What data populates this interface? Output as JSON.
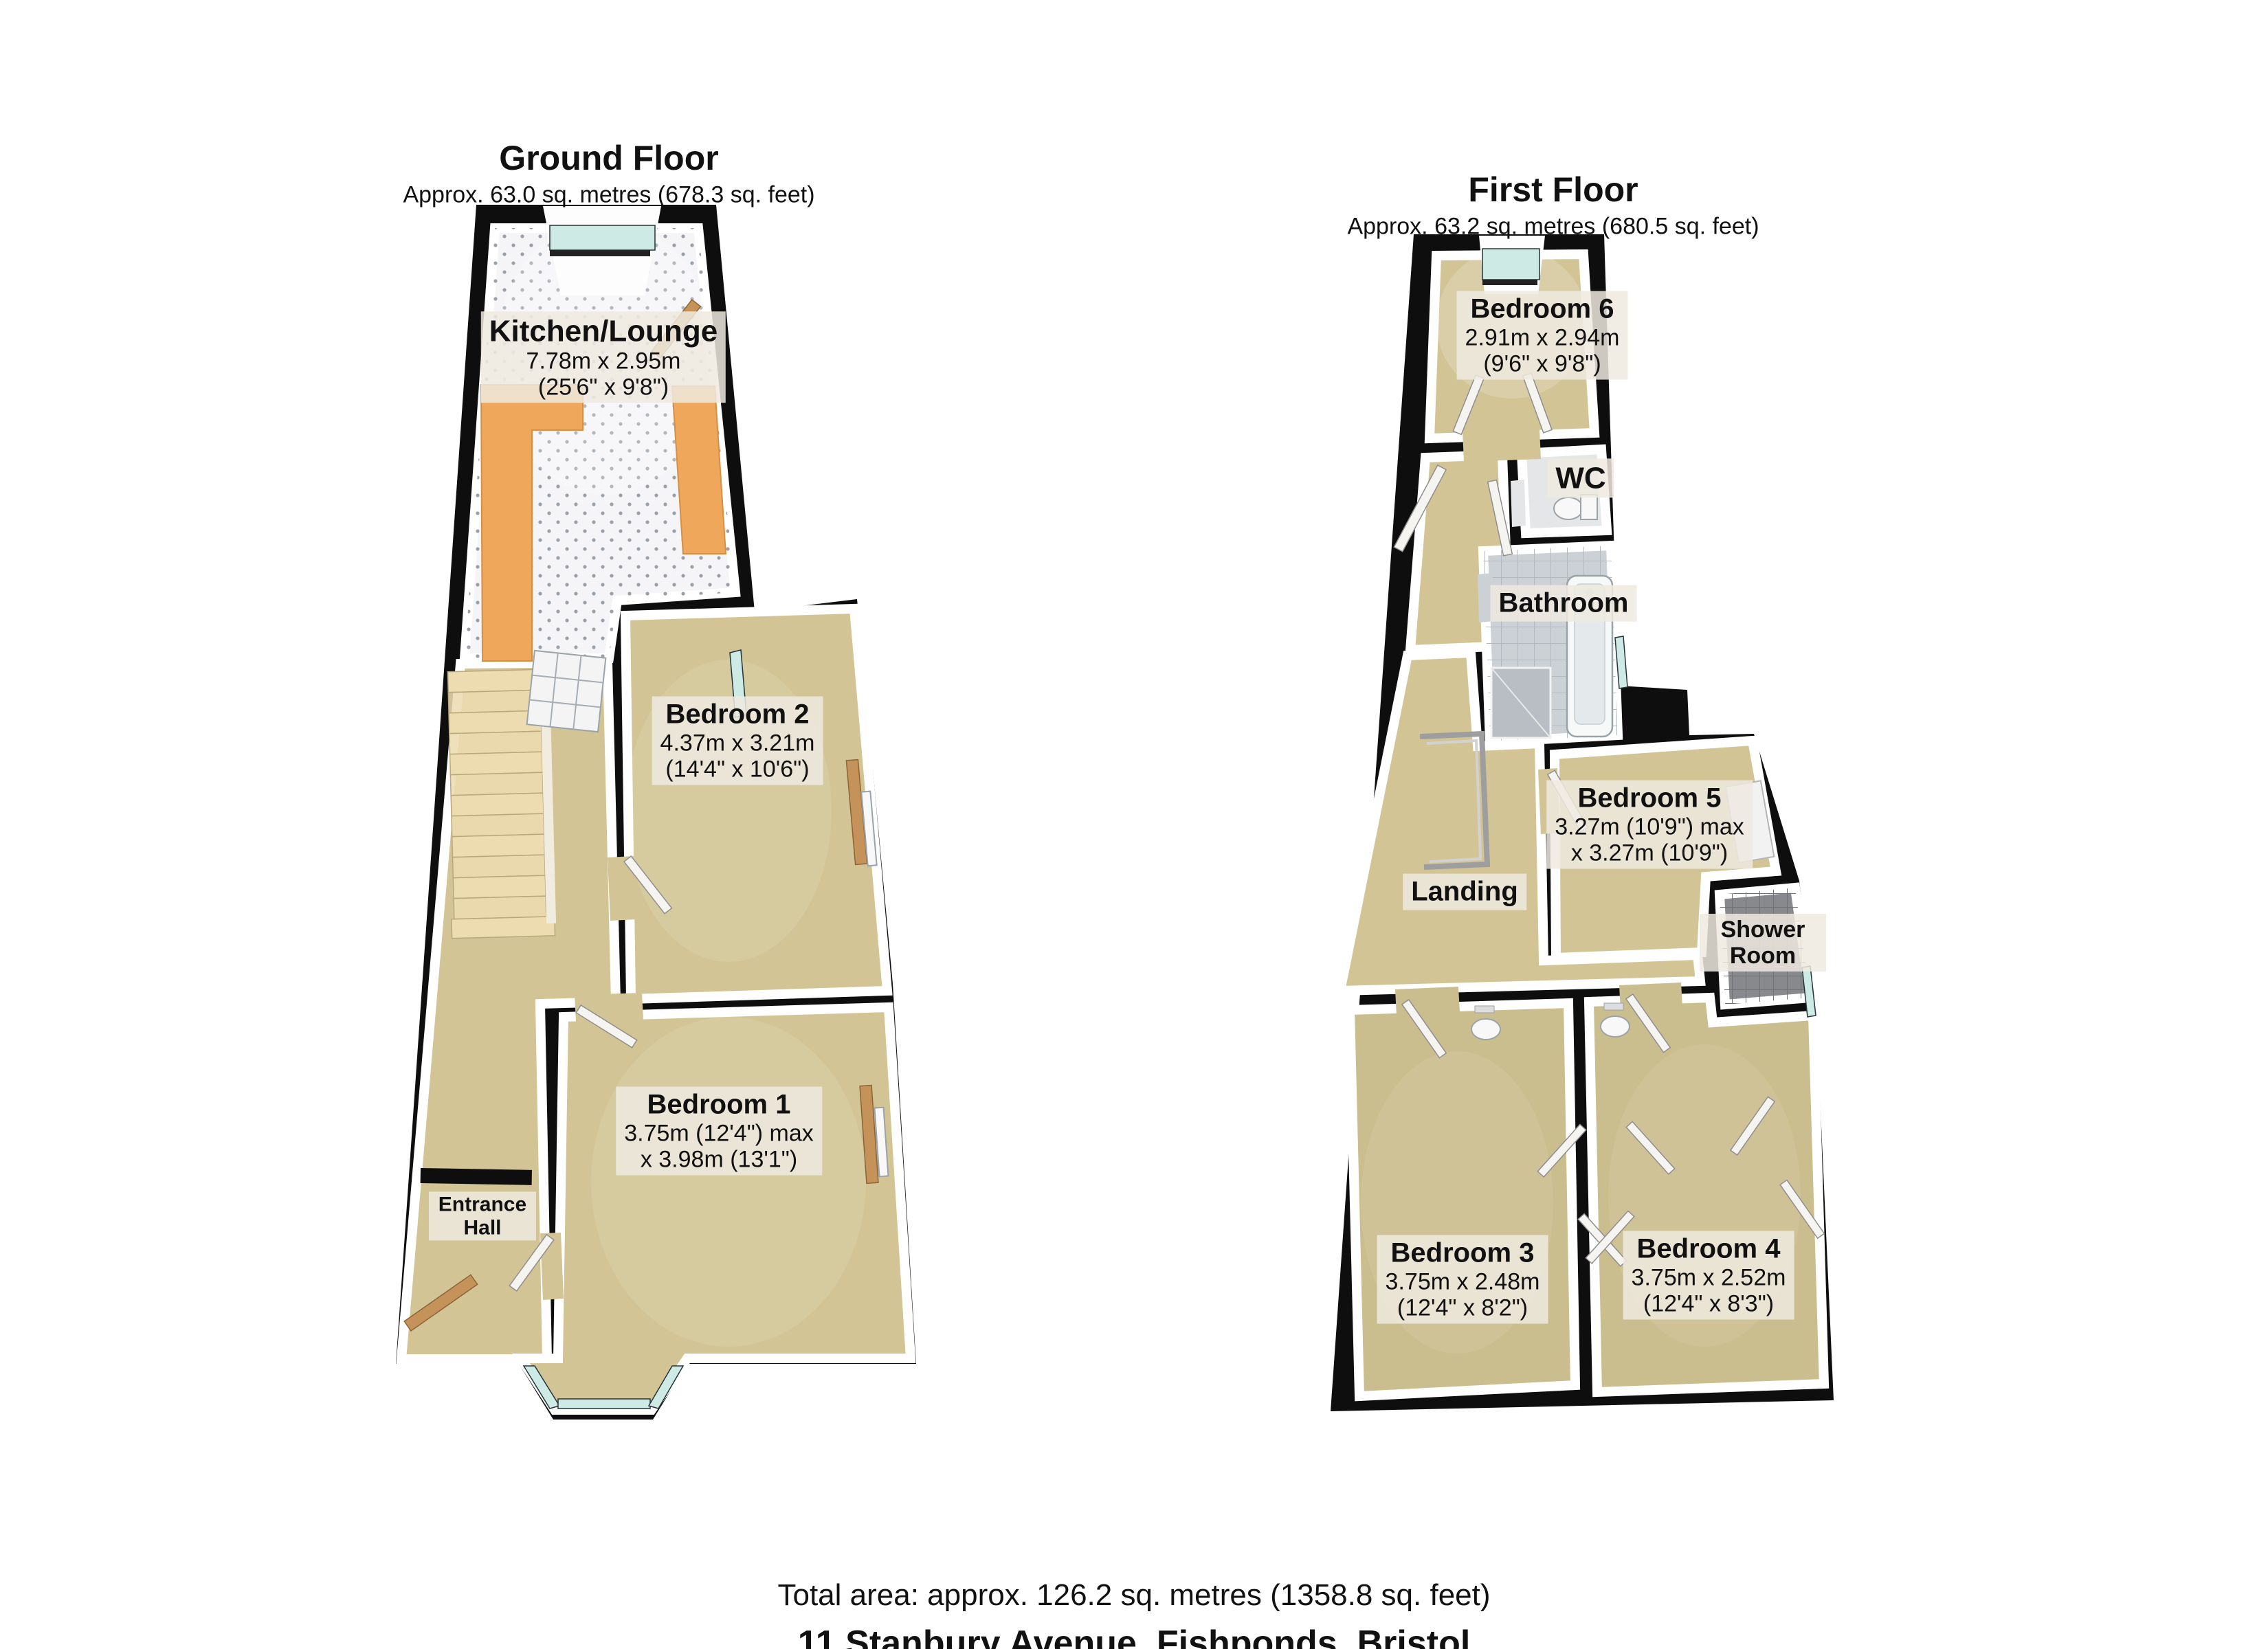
{
  "page": {
    "background": "#ffffff"
  },
  "palette": {
    "wall": "#0e0e0e",
    "inner_wall": "#ffffff",
    "carpet": "#d2c495",
    "carpet_dark": "#cabd8e",
    "kitchen_floor": "#f5f5f7",
    "counter": "#efa85b",
    "stairs": "#ecdcb0",
    "window_glass": "#cdeae4",
    "tile": "#ccd1d5",
    "wc_floor": "#e4e6e8",
    "shower_floor": "#87898d",
    "label_bg": "#eeeae0",
    "text": "#111111"
  },
  "ground_floor": {
    "title": "Ground Floor",
    "subtitle": "Approx. 63.0 sq. metres (678.3 sq. feet)",
    "rooms": {
      "kitchen_lounge": {
        "name": "Kitchen/Lounge",
        "metric": "7.78m x 2.95m",
        "imperial": "(25'6\" x 9'8\")"
      },
      "bedroom2": {
        "name": "Bedroom 2",
        "metric": "4.37m x 3.21m",
        "imperial": "(14'4\" x 10'6\")"
      },
      "bedroom1": {
        "name": "Bedroom 1",
        "metric": "3.75m (12'4\") max",
        "imperial": "x 3.98m (13'1\")"
      },
      "entrance_hall": {
        "name": "Entrance Hall"
      }
    }
  },
  "first_floor": {
    "title": "First Floor",
    "subtitle": "Approx. 63.2 sq. metres (680.5 sq. feet)",
    "rooms": {
      "bedroom6": {
        "name": "Bedroom 6",
        "metric": "2.91m x 2.94m",
        "imperial": "(9'6\" x 9'8\")"
      },
      "wc": {
        "name": "WC"
      },
      "bathroom": {
        "name": "Bathroom"
      },
      "landing": {
        "name": "Landing"
      },
      "bedroom5": {
        "name": "Bedroom 5",
        "metric": "3.27m (10'9\") max",
        "imperial": "x 3.27m (10'9\")"
      },
      "shower_room": {
        "name": "Shower Room"
      },
      "bedroom3": {
        "name": "Bedroom 3",
        "metric": "3.75m x 2.48m",
        "imperial": "(12'4\" x 8'2\")"
      },
      "bedroom4": {
        "name": "Bedroom 4",
        "metric": "3.75m x 2.52m",
        "imperial": "(12'4\" x 8'3\")"
      }
    }
  },
  "footer": {
    "total_area": "Total area: approx. 126.2 sq. metres (1358.8 sq. feet)",
    "address": "11 Stanbury Avenue, Fishponds, Bristol"
  }
}
